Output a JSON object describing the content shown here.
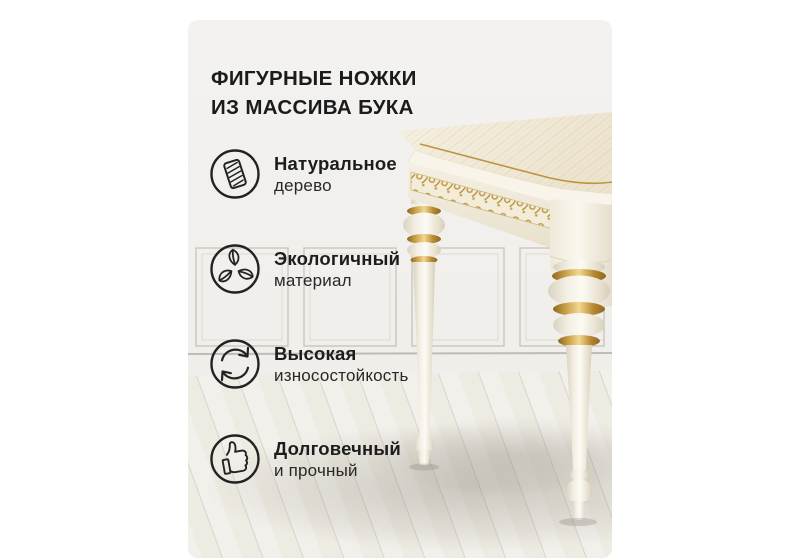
{
  "card": {
    "title_line1": "ФИГУРНЫЕ НОЖКИ",
    "title_line2": "ИЗ МАССИВА БУКА",
    "features": [
      {
        "icon": "wood-plank-icon",
        "line1": "Натуральное",
        "line2": "дерево"
      },
      {
        "icon": "eco-leaves-icon",
        "line1": "Экологичный",
        "line2": "материал"
      },
      {
        "icon": "sync-arrows-icon",
        "line1": "Высокая",
        "line2": "износостойкость"
      },
      {
        "icon": "thumbs-up-icon",
        "line1": "Долговечный",
        "line2": "и прочный"
      }
    ]
  },
  "colors": {
    "canvas": "#ffffff",
    "card_background": "#f1efec",
    "text": "#1d1d1d",
    "icon_stroke": "#222222",
    "gold_accent": "#c2953c",
    "table_cream": "#f3ecdc"
  }
}
